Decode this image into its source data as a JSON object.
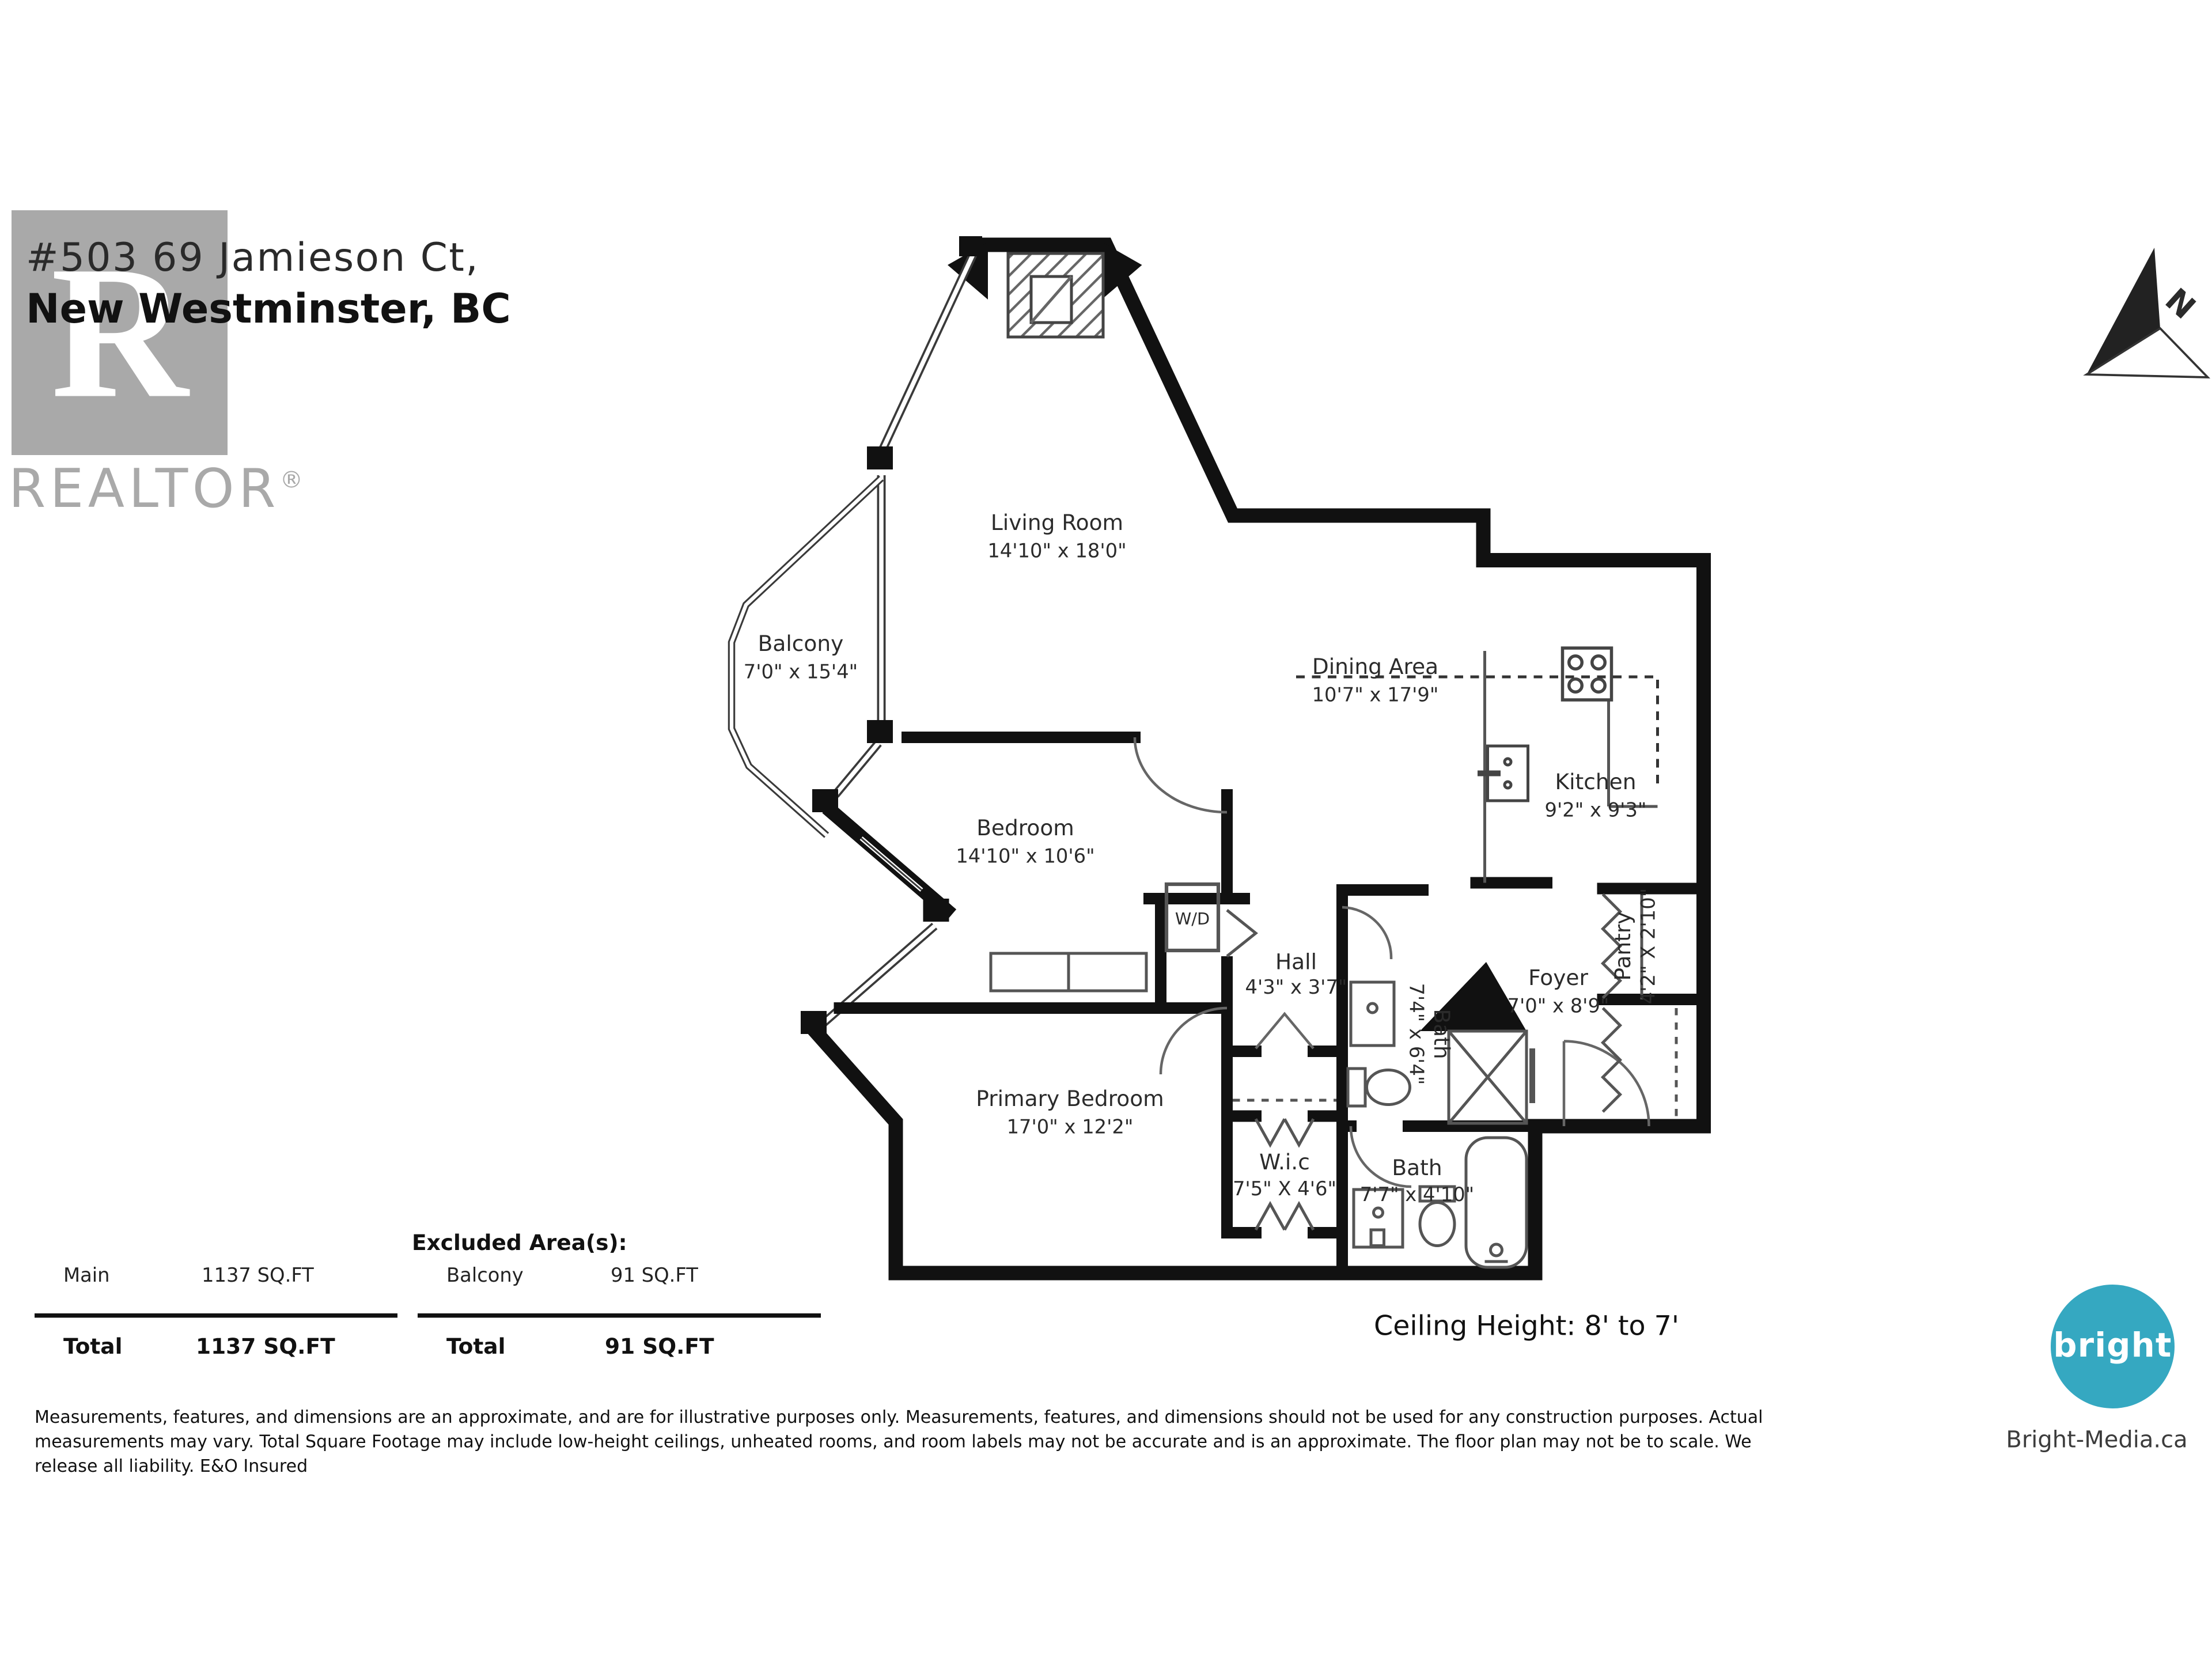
{
  "address": {
    "line1": "#503 69 Jamieson Ct,",
    "line2": "New Westminster, BC"
  },
  "watermark": {
    "monogram": "R",
    "label": "REALTOR",
    "registered": "®"
  },
  "north_arrow": {
    "label": "N"
  },
  "rooms": {
    "living_room": {
      "name": "Living Room",
      "dims": "14'10\" x 18'0\""
    },
    "balcony": {
      "name": "Balcony",
      "dims": "7'0\" x 15'4\""
    },
    "dining_area": {
      "name": "Dining Area",
      "dims": "10'7\" x 17'9\""
    },
    "kitchen": {
      "name": "Kitchen",
      "dims": "9'2\" x 9'3\""
    },
    "bedroom": {
      "name": "Bedroom",
      "dims": "14'10\" x 10'6\""
    },
    "primary_bedroom": {
      "name": "Primary Bedroom",
      "dims": "17'0\" x 12'2\""
    },
    "hall": {
      "name": "Hall",
      "dims": "4'3\" x 3'7\""
    },
    "bath_upper": {
      "name": "Bath",
      "dims": "7'4\" x 6'4\""
    },
    "bath_lower": {
      "name": "Bath",
      "dims": "7'7\" x 4'10\""
    },
    "wic": {
      "name": "W.i.c",
      "dims": "7'5\" X 4'6\""
    },
    "pantry": {
      "name": "Pantry",
      "dims": "4'2\" X 2'10\""
    },
    "foyer": {
      "name": "Foyer",
      "dims": "7'0\" x 8'9\""
    },
    "washer_dryer": {
      "label": "W/D"
    }
  },
  "areas": {
    "excluded_header": "Excluded Area(s):",
    "main_label": "Main",
    "main_value": "1137 SQ.FT",
    "balcony_label": "Balcony",
    "balcony_value": "91 SQ.FT",
    "total_label_main": "Total",
    "total_value_main": "1137 SQ.FT",
    "total_label_excluded": "Total",
    "total_value_excluded": "91 SQ.FT"
  },
  "ceiling_height": "Ceiling Height: 8' to 7'",
  "disclaimer": {
    "line1": "Measurements, features, and dimensions are an approximate, and are for illustrative purposes only. Measurements, features, and dimensions should not be used for any construction purposes. Actual",
    "line2": "measurements may vary. Total Square Footage may include low-height ceilings, unheated rooms, and room labels may not be accurate and is an approximate. The floor plan may not be to scale. We",
    "line3": "release all liability. E&O Insured"
  },
  "branding": {
    "logo_text": "bright",
    "website": "Bright-Media.ca",
    "logo_color": "#35a8c1"
  }
}
